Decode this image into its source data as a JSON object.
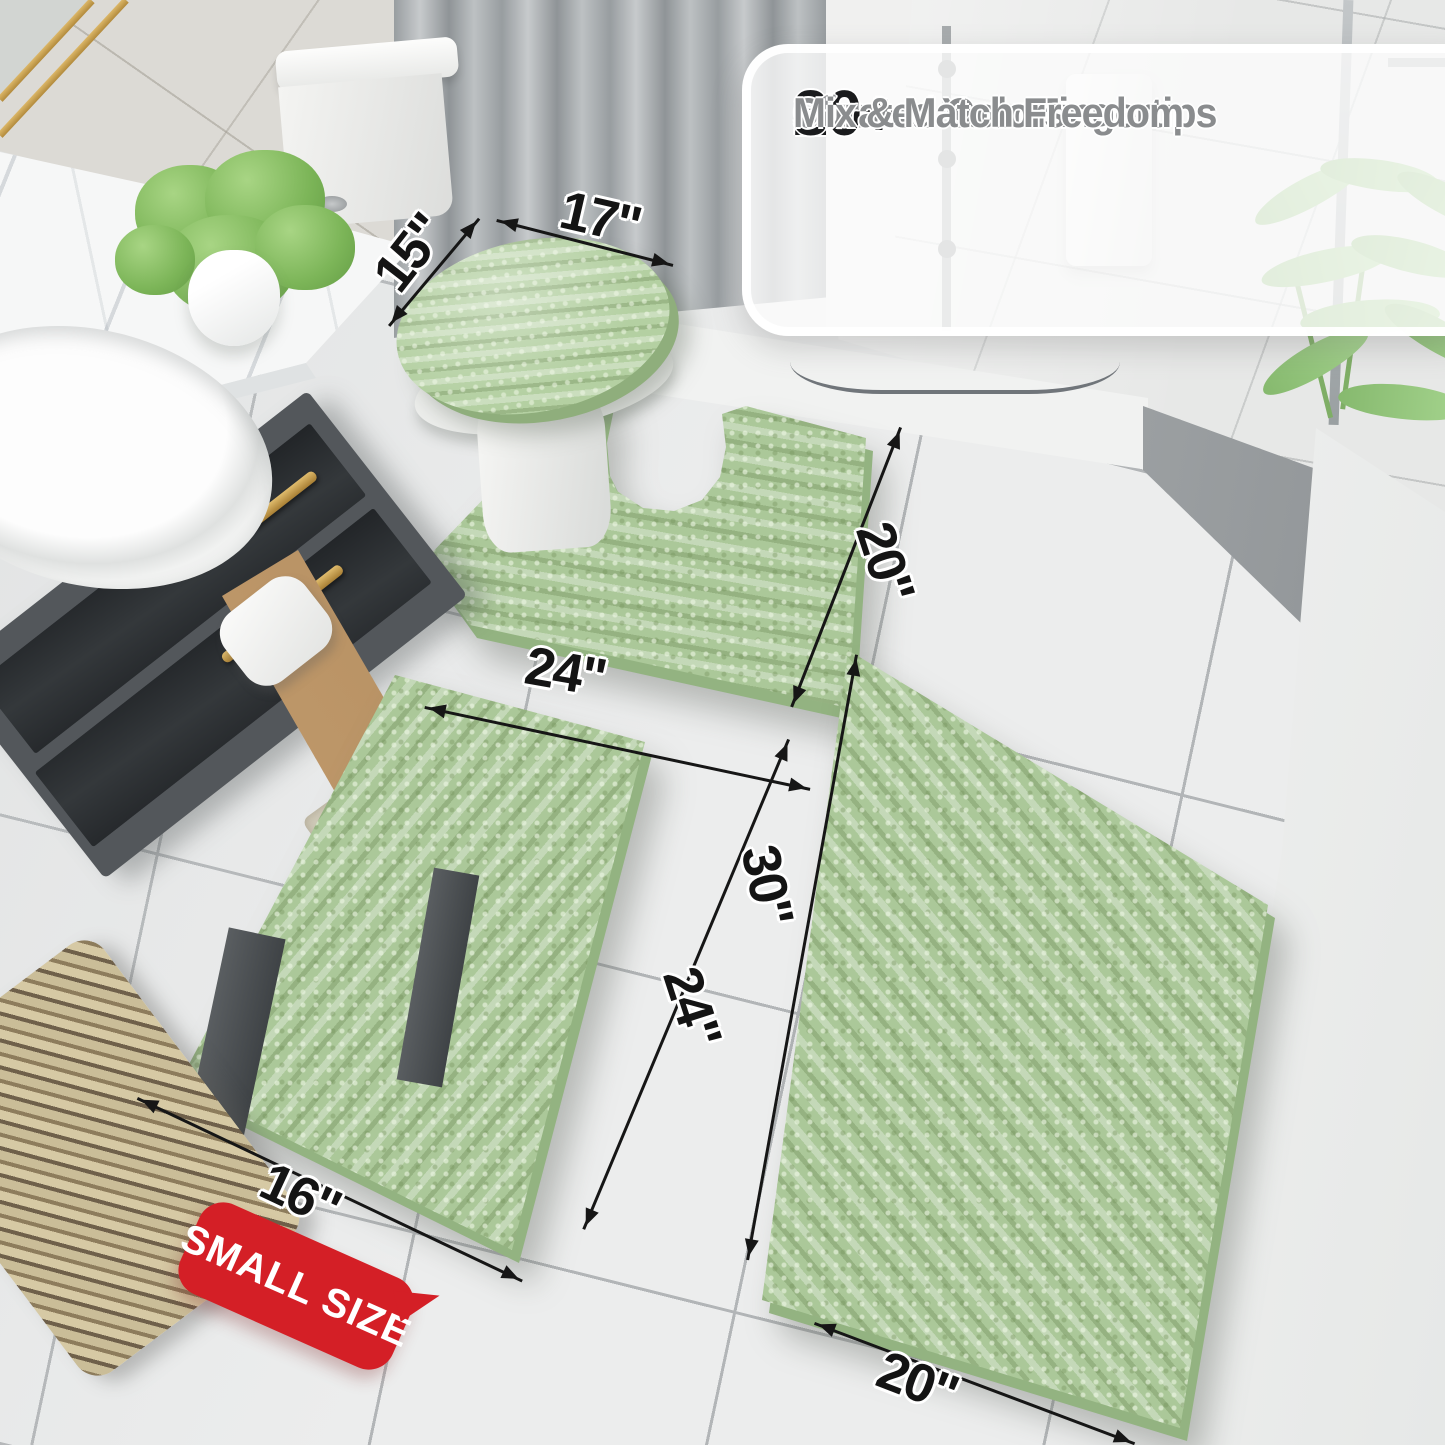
{
  "callout": {
    "check_glyph": "✔",
    "items": [
      {
        "stat": "20+",
        "label": "Sizes at Your Fingertips"
      },
      {
        "stat": "30+",
        "label": "Curated Colors"
      },
      {
        "stat": "",
        "label": "Mix & Match Freedom"
      }
    ]
  },
  "dimension_labels": {
    "lid_top": "17\"",
    "lid_side": "15\"",
    "contour_bottom": "24\"",
    "contour_side": "20\"",
    "small_front": "16\"",
    "small_side": "24\"",
    "large_side": "30\"",
    "large_bottom": "20\""
  },
  "badge": {
    "text": "SMALL SIZE"
  },
  "vanity": {
    "bottle_label": "MISCL"
  },
  "colors": {
    "rug_green": "#abc899",
    "rug_edge_green": "#93b381",
    "badge_red": "#d41f26",
    "stat_text": "#1a1b1d",
    "feature_text": "#8a8c8e",
    "arrow_black": "#161616",
    "gold_accent": "#c7a04c"
  }
}
